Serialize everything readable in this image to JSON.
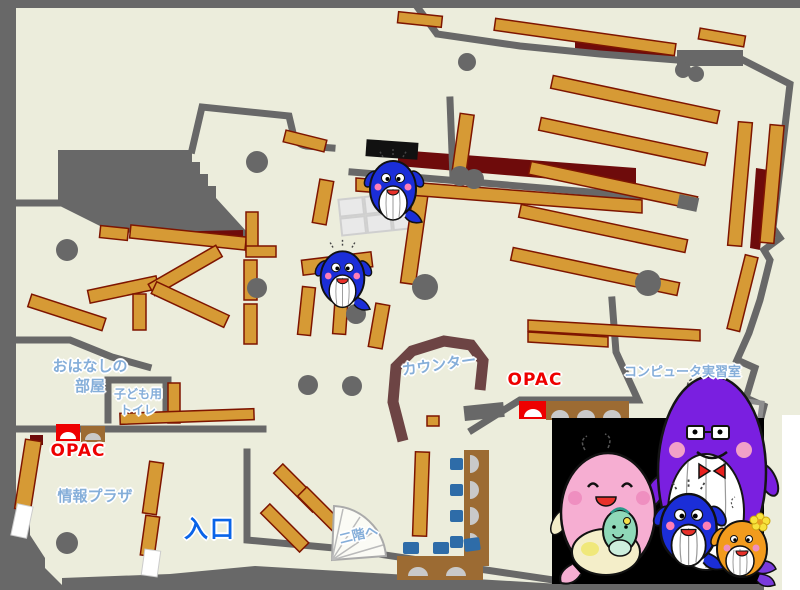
{
  "theme": {
    "floor": "#eceddc",
    "wall": "#686868",
    "shelf": "#d69a35",
    "shelf_border": "#7e1500",
    "maroon": "#6e0b0b",
    "counter_brown": "#6d4444",
    "desk_brown": "#9c6b33",
    "chair_blue": "#2e6ca8",
    "seat_gray": "#c9c9c9",
    "opac_red": "#ee0000",
    "label_blue": "#85aed9",
    "entrance_blue": "#0a64e8",
    "photo_bg": "#000000",
    "whale_blue": "#1b2ed8",
    "whale_pink": "#f6aed2",
    "whale_purple": "#7a1fe0",
    "whale_orange": "#f29b1d",
    "baby_green": "#8fd8b8"
  },
  "labels": {
    "storytelling_room": "おはなしの\n部屋",
    "kids_toilet": "子ども用\nトイレ",
    "opac_left": "OPAC",
    "info_plaza": "情報プラザ",
    "entrance": "入口",
    "counter": "カウンター",
    "opac_right": "OPAC",
    "computer_room": "コンピュータ実習室",
    "second_floor": "二階へ"
  },
  "mascots": [
    "blue-whale-small-upper",
    "blue-whale-small-lower",
    "mother-whale-pink",
    "baby-whale-green",
    "father-whale-purple",
    "child-whale-blue",
    "child-whale-orange"
  ]
}
